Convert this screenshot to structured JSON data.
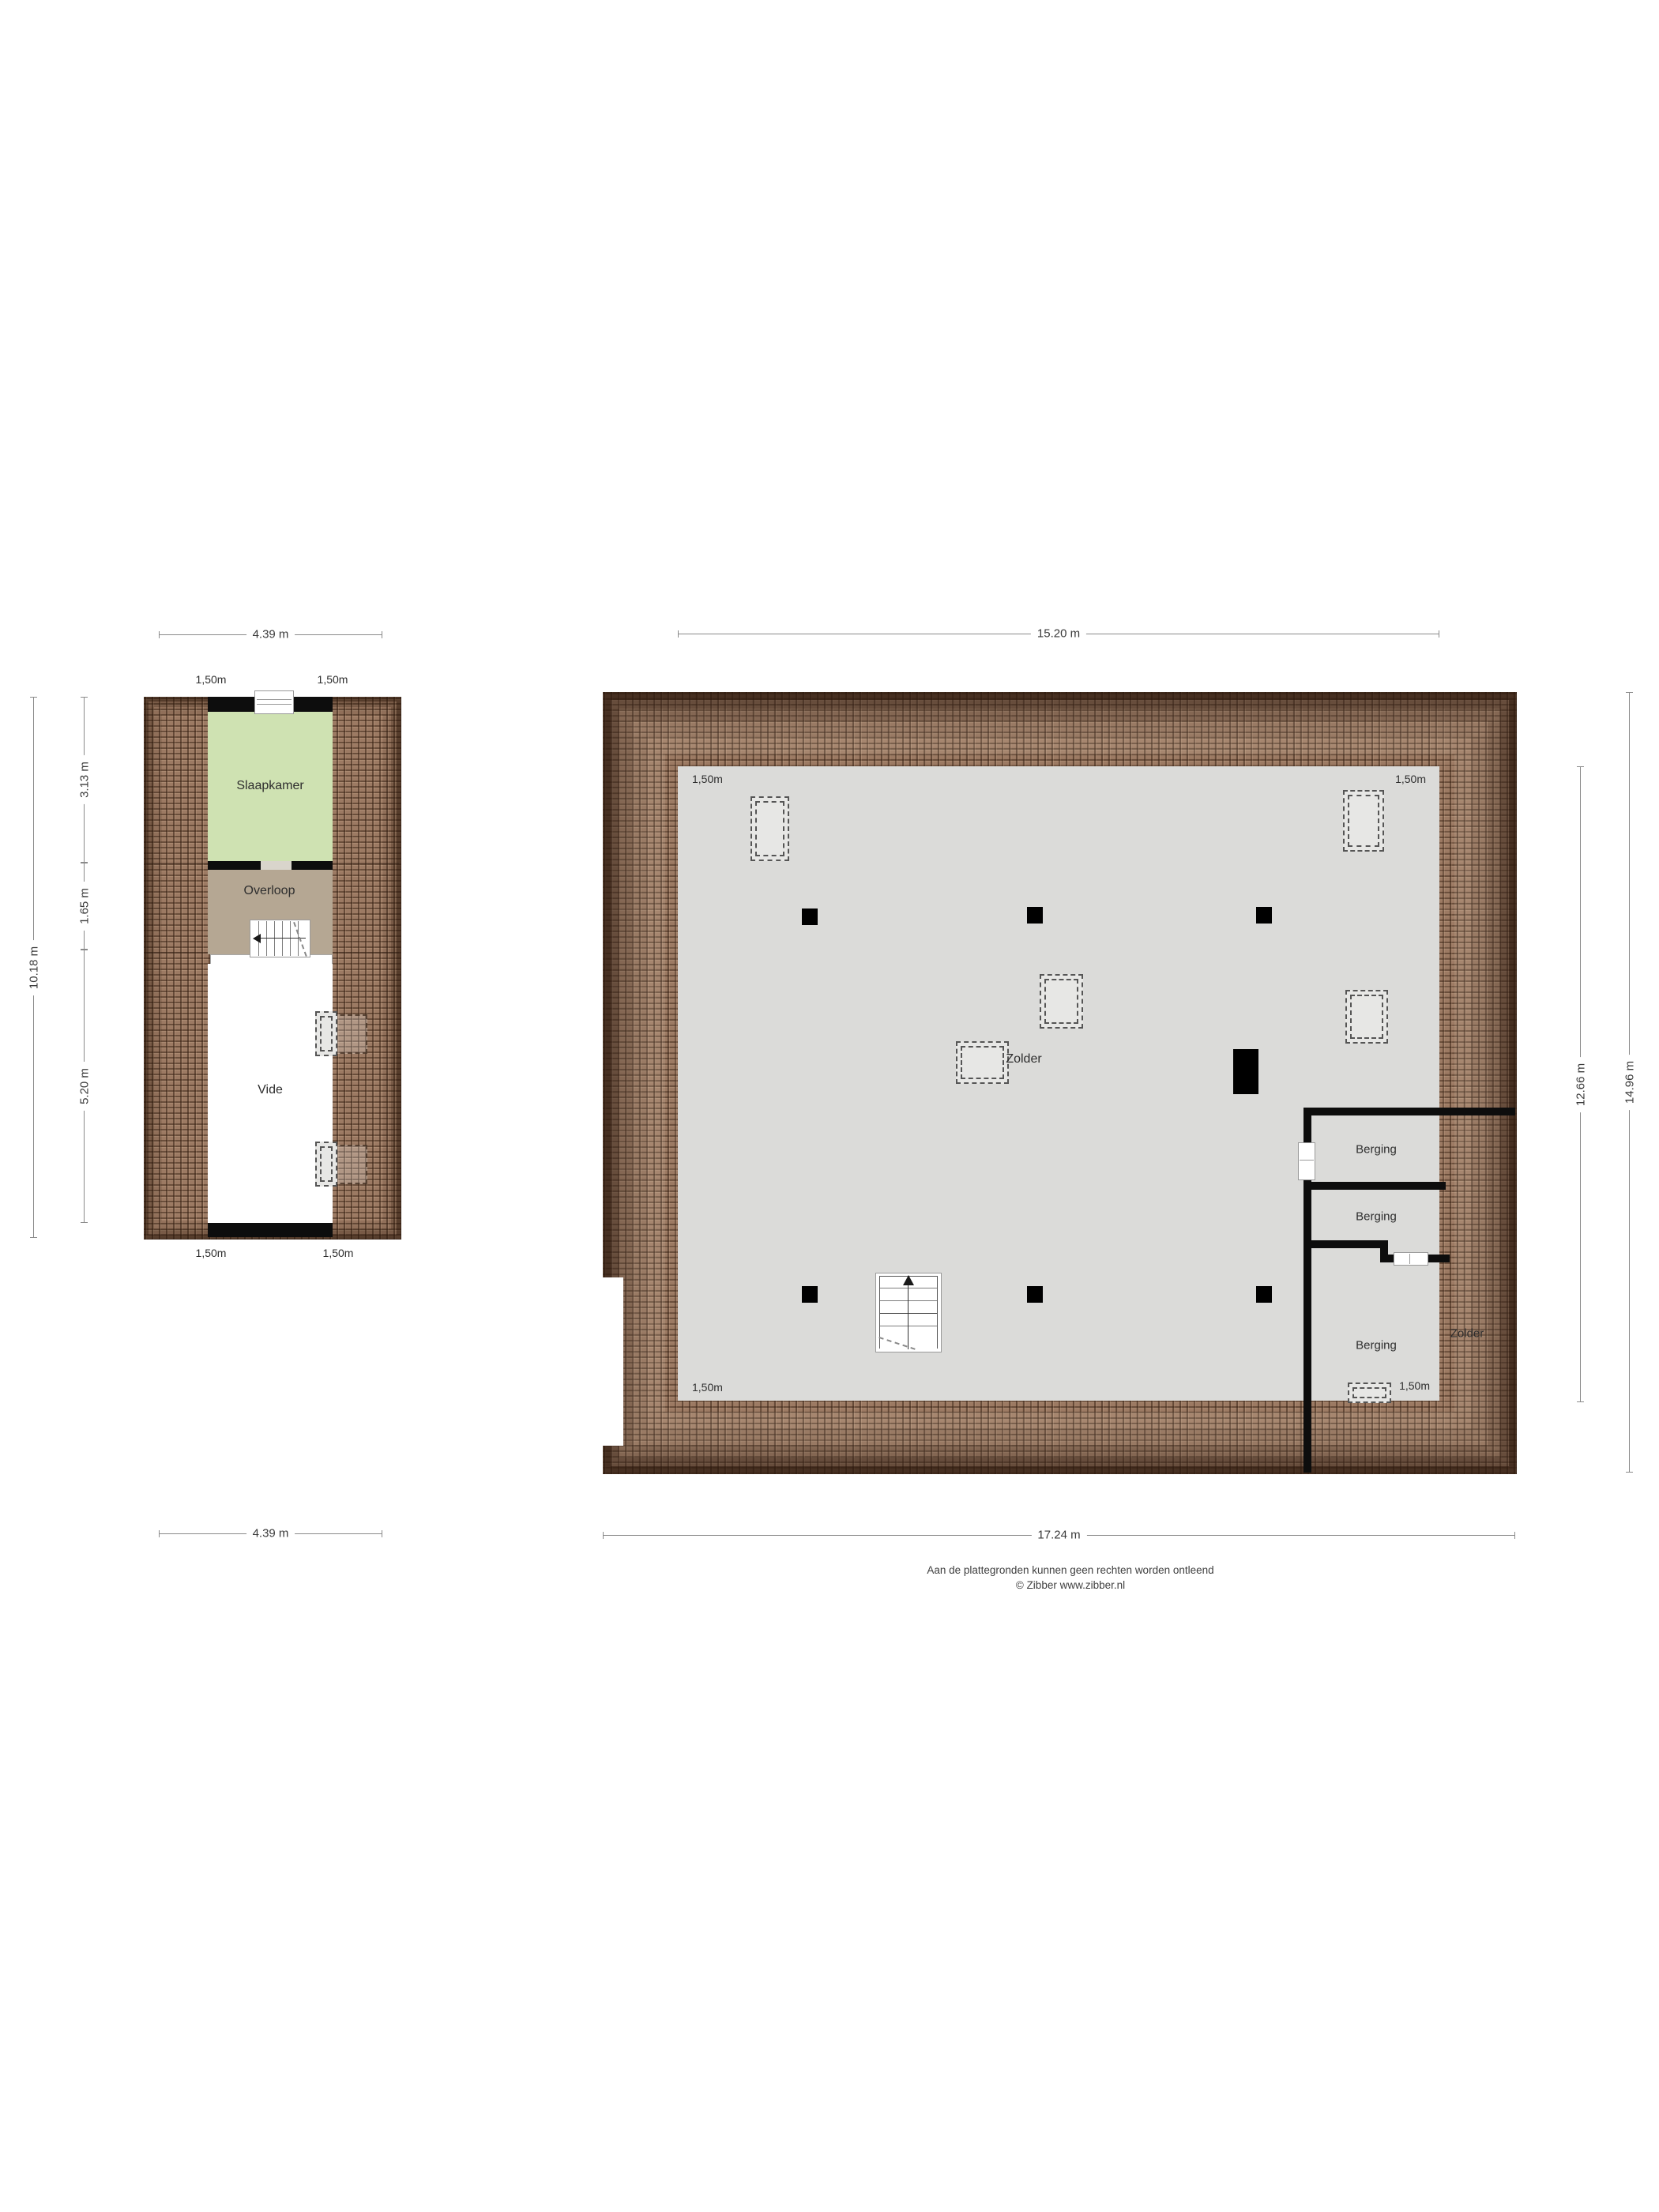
{
  "colors": {
    "roof-base": "#9c7a63",
    "roof-grout": "#3c2615",
    "floor-gray": "#dbdbd9",
    "green": "#cfe2b2",
    "tan": "#b5a793",
    "wall": "#0d0d0d",
    "dim": "#8a8a8a",
    "txt": "#3a3a3a"
  },
  "left_plan": {
    "dims": {
      "top": "4.39 m",
      "bottom": "4.39 m",
      "outer_left": "10.18 m",
      "seg_slaapkamer": "3.13 m",
      "seg_overloop": "1.65 m",
      "seg_vide": "5.20 m"
    },
    "knee": {
      "top_left": "1,50m",
      "top_right": "1,50m",
      "bottom_left": "1,50m",
      "bottom_right": "1,50m"
    },
    "rooms": {
      "slaapkamer": "Slaapkamer",
      "overloop": "Overloop",
      "vide": "Vide"
    }
  },
  "right_plan": {
    "dims": {
      "top": "15.20 m",
      "bottom": "17.24 m",
      "inner_right": "12.66 m",
      "outer_right": "14.96 m"
    },
    "knee": {
      "top_left": "1,50m",
      "top_right": "1,50m",
      "bottom_left": "1,50m",
      "berging": "1,50m"
    },
    "rooms": {
      "zolder": "Zolder",
      "zolder_right": "Zolder",
      "berging1": "Berging",
      "berging2": "Berging",
      "berging3": "Berging"
    }
  },
  "footer": {
    "line1": "Aan de plattegronden kunnen geen rechten worden ontleend",
    "line2": "© Zibber www.zibber.nl"
  }
}
